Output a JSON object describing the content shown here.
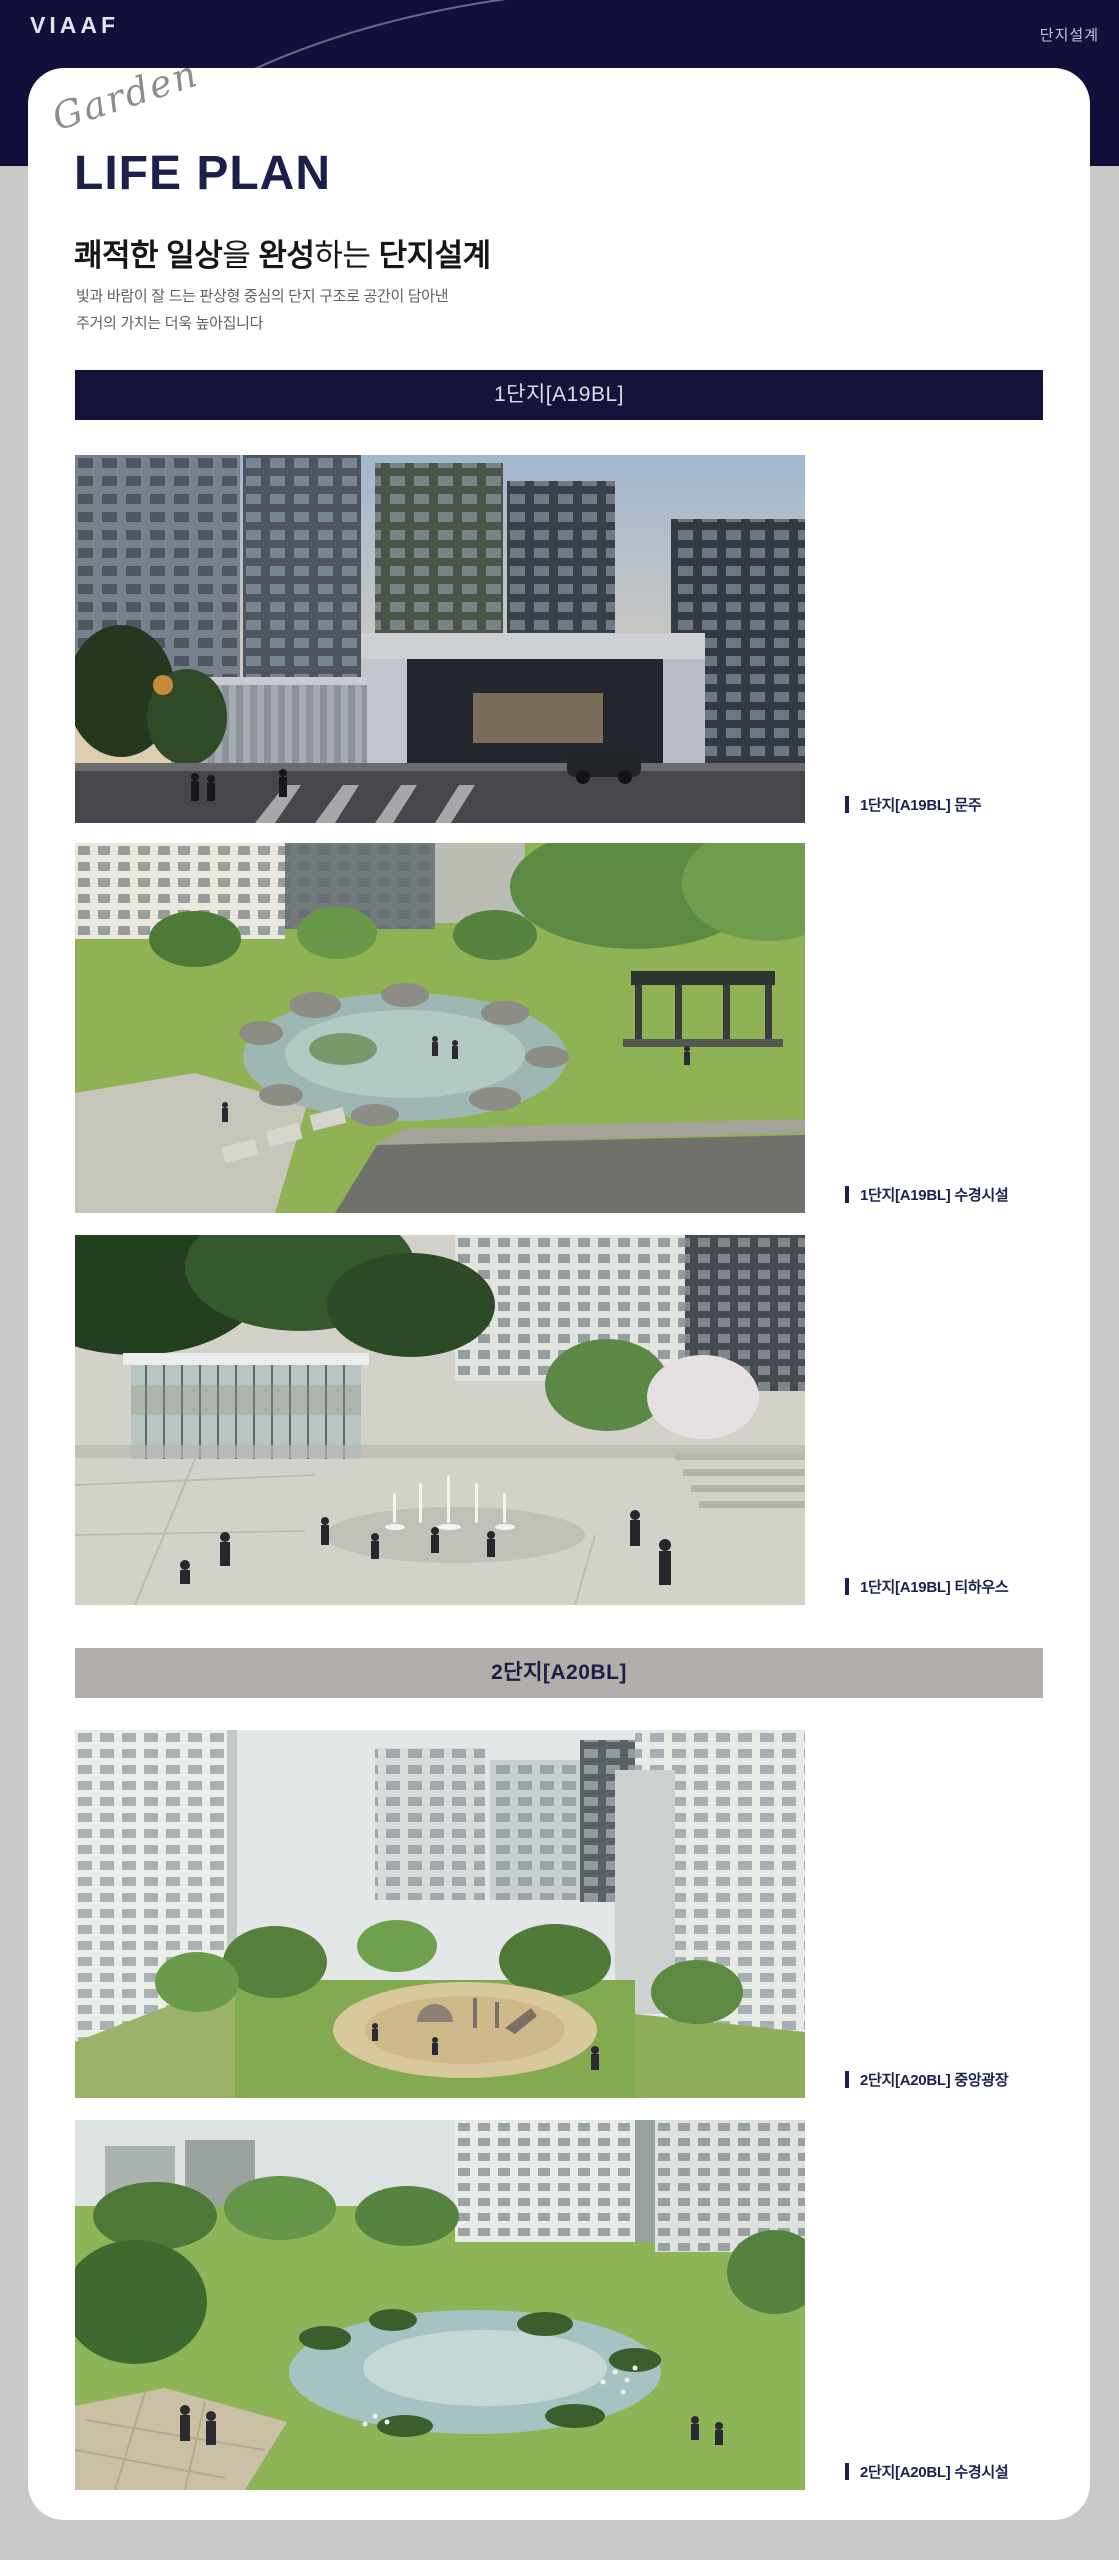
{
  "header": {
    "logo": "VIAAF",
    "nav_label": "단지설계"
  },
  "hero": {
    "script_word": "Garden",
    "title": "LIFE PLAN",
    "subtitle": {
      "seg1_bold": "쾌적한 일상",
      "seg2": "을 ",
      "seg3_bold": "완성",
      "seg4": "하는 ",
      "seg5_bold": "단지설계"
    },
    "description_line1": "빛과 바람이 잘 드는 판상형 중심의 단지 구조로 공간이 담아낸",
    "description_line2": "주거의 가치는 더욱 높아집니다"
  },
  "sections": [
    {
      "banner_label": "1단지[A19BL]",
      "figures": [
        {
          "caption": "1단지[A19BL] 문주"
        },
        {
          "caption": "1단지[A19BL] 수경시설"
        },
        {
          "caption": "1단지[A19BL] 티하우스"
        }
      ]
    },
    {
      "banner_label": "2단지[A20BL]",
      "figures": [
        {
          "caption": "2단지[A20BL] 중앙광장"
        },
        {
          "caption": "2단지[A20BL] 수경시설"
        }
      ]
    }
  ],
  "colors": {
    "header_navy": "#12103a",
    "banner_navy": "#15133b",
    "banner_gray": "#b1aeab",
    "page_background": "#c9c9c9",
    "card_background": "#ffffff",
    "caption_navy": "#1c2150",
    "title_navy": "#1b1f4a"
  }
}
